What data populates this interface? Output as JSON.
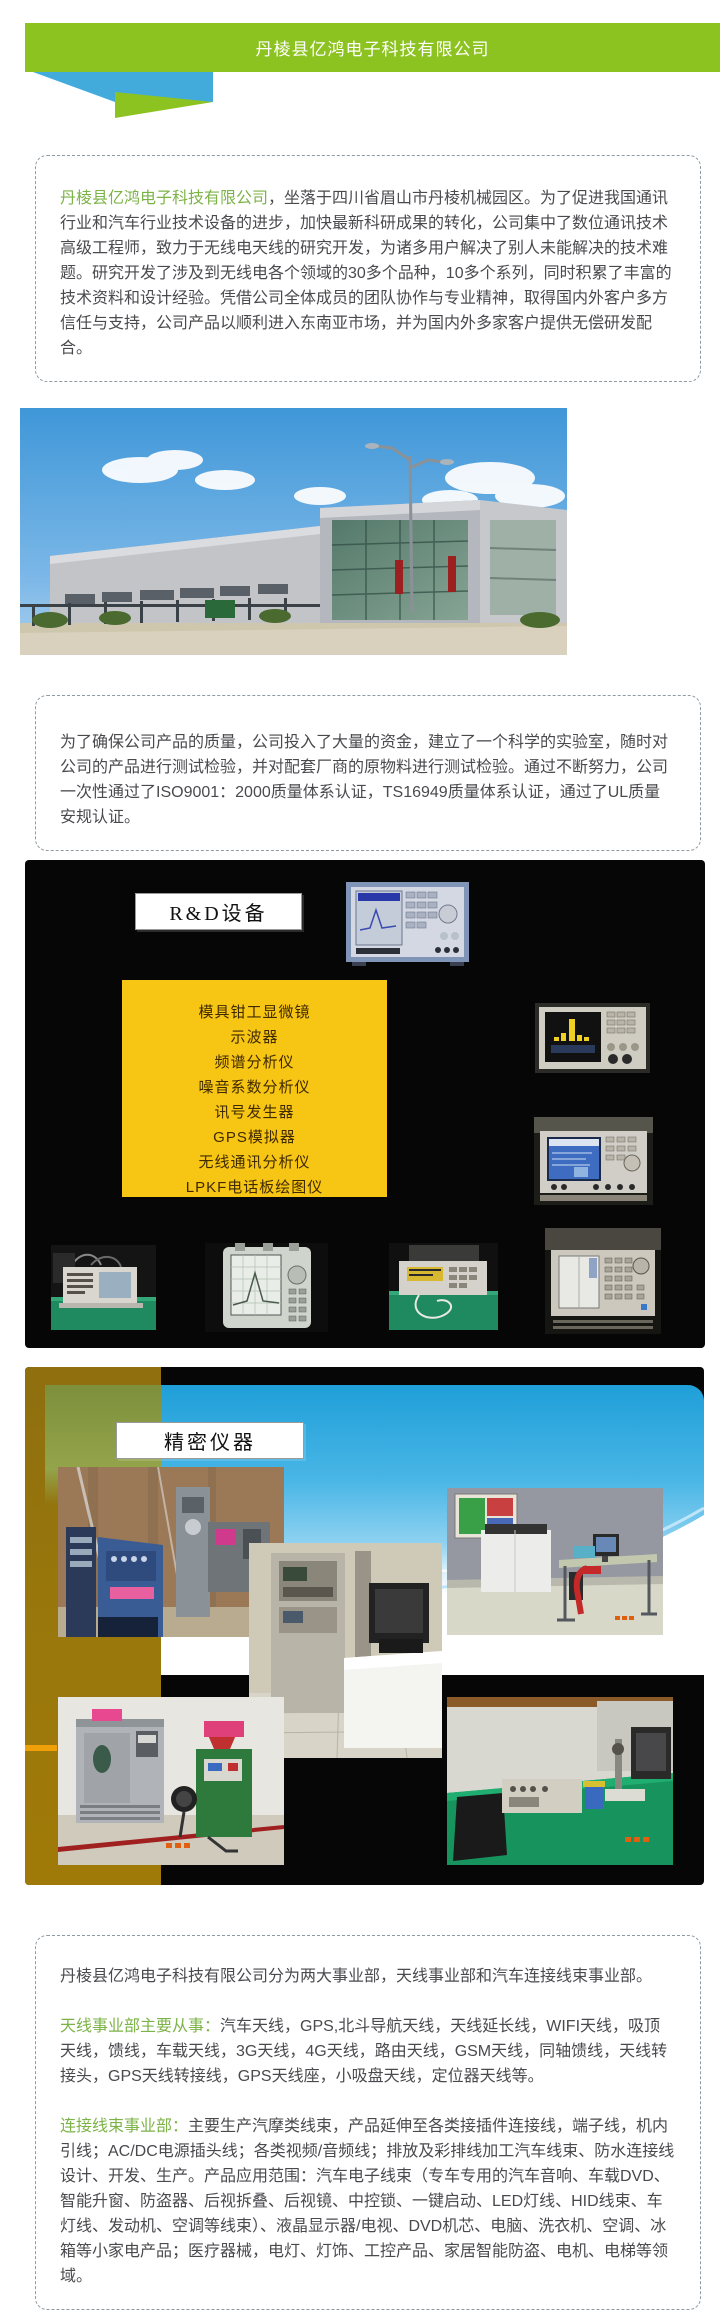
{
  "header": {
    "title": "丹棱县亿鸿电子科技有限公司"
  },
  "intro": {
    "company_name": "丹棱县亿鸿电子科技有限公司",
    "text": "，坐落于四川省眉山市丹棱机械园区。为了促进我国通讯行业和汽车行业技术设备的进步，加快最新科研成果的转化，公司集中了数位通讯技术高级工程师，致力于无线电天线的研究开发，为诸多用户解决了别人未能解决的技术难题。研究开发了涉及到无线电各个领域的30多个品种，10多个系列，同时积累了丰富的技术资料和设计经验。凭借公司全体成员的团队协作与专业精神，取得国内外客户多方信任与支持，公司产品以顺利进入东南亚市场，并为国内外多家客户提供无偿研发配合。"
  },
  "quality": {
    "text": "为了确保公司产品的质量，公司投入了大量的资金，建立了一个科学的实验室，随时对公司的产品进行测试检验，并对配套厂商的原物料进行测试检验。通过不断努力，公司一次性通过了ISO9001：2000质量体系认证，TS16949质量体系认证，通过了UL质量安规认证。"
  },
  "rd_slide": {
    "label": "R&D设备",
    "equipment_list": [
      "模具钳工显微镜",
      "示波器",
      "频谱分析仪",
      "噪音系数分析仪",
      "讯号发生器",
      "GPS模拟器",
      "无线通讯分析仪",
      "LPKF电话板绘图仪"
    ]
  },
  "precision_slide": {
    "label": "精密仪器"
  },
  "divisions": {
    "overview": "丹棱县亿鸿电子科技有限公司分为两大事业部，天线事业部和汽车连接线束事业部。",
    "antenna": {
      "label": "天线事业部主要从事：",
      "text": "汽车天线，GPS,北斗导航天线，天线延长线，WIFI天线，吸顶天线，馈线，车载天线，3G天线，4G天线，路由天线，GSM天线，同轴馈线，天线转接头，GPS天线转接线，GPS天线座，小吸盘天线，定位器天线等。"
    },
    "harness": {
      "label": "连接线束事业部：",
      "text": "主要生产汽摩类线束，产品延伸至各类接插件连接线，端子线，机内引线；AC/DC电源插头线；各类视频/音频线；排放及彩排线加工汽车线束、防水连接线设计、开发、生产。产品应用范围：汽车电子线束（专车专用的汽车音响、车载DVD、智能升窗、防盗器、后视拆叠、后视镜、中控锁、一键启动、LED灯线、HID线束、车灯线、发动机、空调等线束）、液晶显示器/电视、DVD机芯、电脑、洗衣机、空调、冰箱等小家电产品；医疗器械，电灯、灯饰、工控产品、家居智能防盗、电机、电梯等领域。"
    }
  },
  "colors": {
    "brand_green": "#8dc320",
    "ribbon_blue": "#42abdc",
    "accent_text_green": "#7cb347",
    "equipment_box_yellow": "#f7c514"
  }
}
